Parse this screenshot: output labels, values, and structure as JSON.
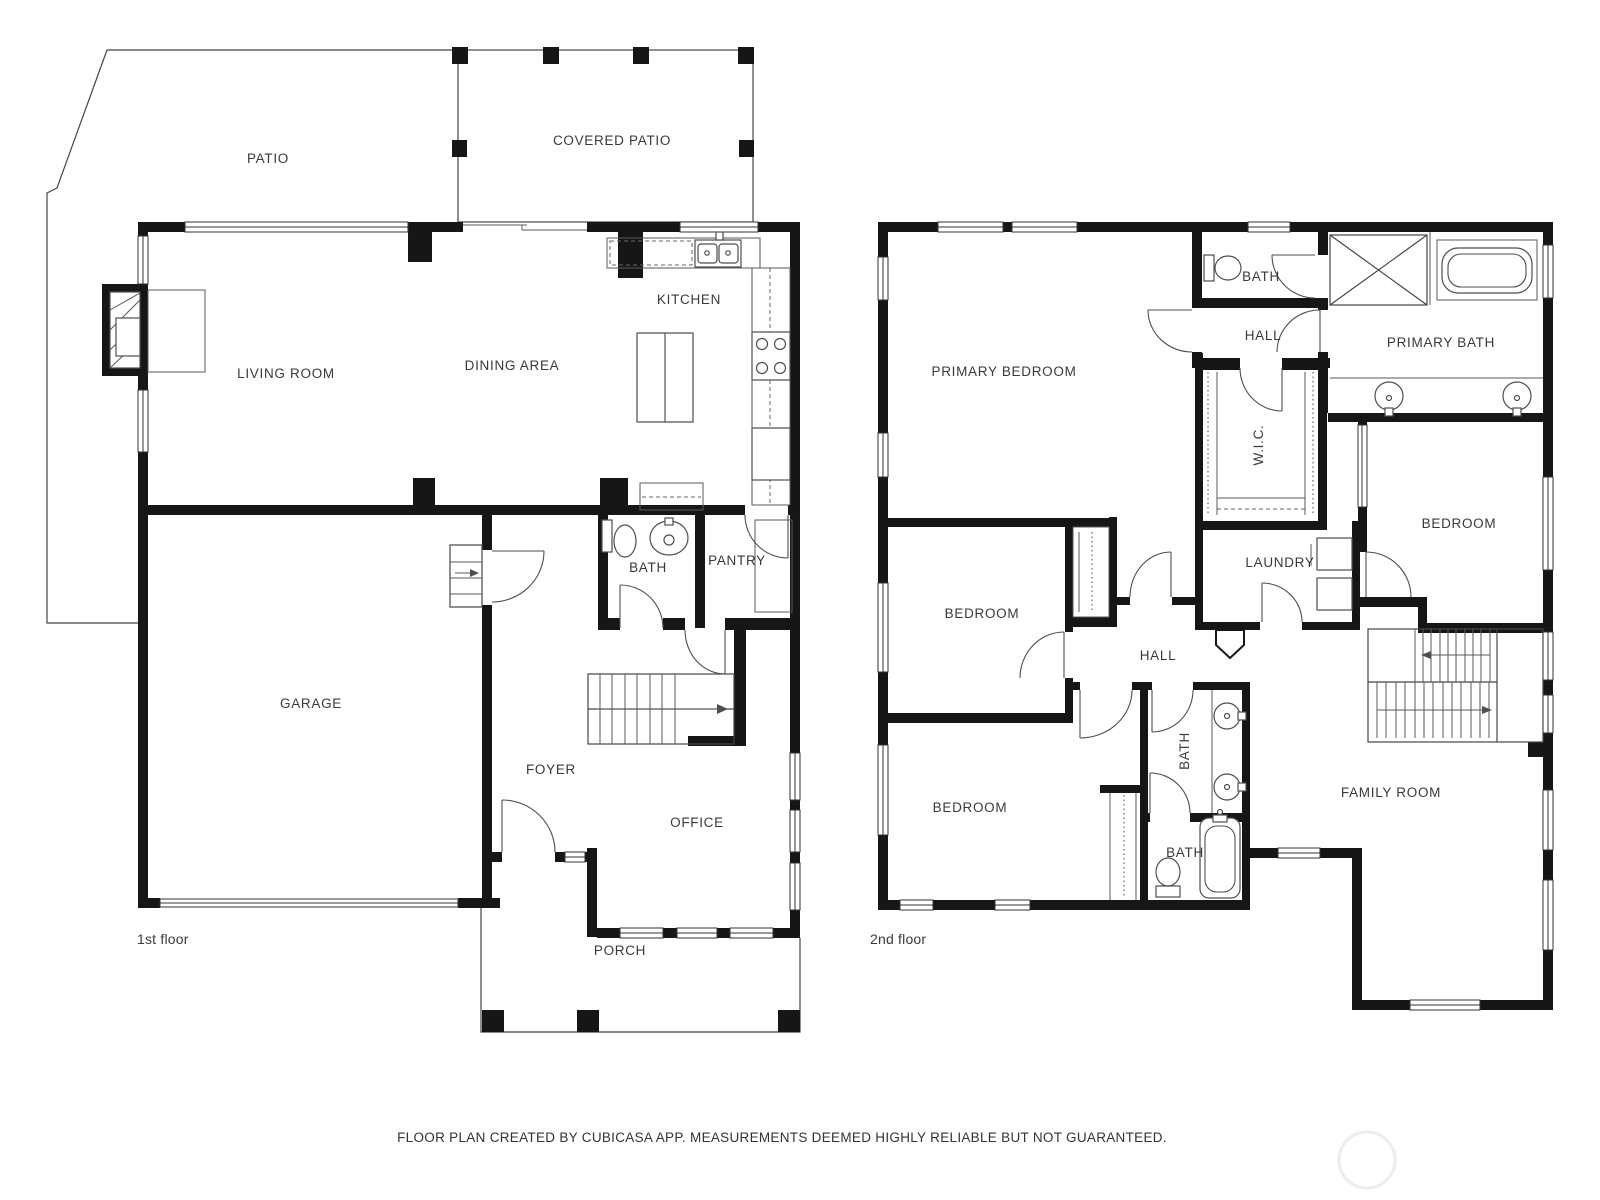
{
  "footer": "FLOOR PLAN CREATED BY CUBICASA APP. MEASUREMENTS DEEMED HIGHLY RELIABLE BUT NOT GUARANTEED.",
  "floor1": {
    "name": "1st floor",
    "rooms": {
      "patio": "PATIO",
      "covered_patio": "COVERED PATIO",
      "kitchen": "KITCHEN",
      "living_room": "LIVING ROOM",
      "dining_area": "DINING AREA",
      "bath": "BATH",
      "pantry": "PANTRY",
      "garage": "GARAGE",
      "foyer": "FOYER",
      "office": "OFFICE",
      "porch": "PORCH"
    }
  },
  "floor2": {
    "name": "2nd floor",
    "rooms": {
      "primary_bedroom": "PRIMARY BEDROOM",
      "bath_upper": "BATH",
      "hall_upper": "HALL",
      "primary_bath": "PRIMARY BATH",
      "wic": "W.I.C.",
      "bedroom_right": "BEDROOM",
      "laundry": "LAUNDRY",
      "bedroom_mid": "BEDROOM",
      "hall_mid": "HALL",
      "bath_mid": "BATH",
      "bedroom_lower": "BEDROOM",
      "bath_lower": "BATH",
      "family_room": "FAMILY ROOM"
    }
  },
  "colors": {
    "wall": "#161616",
    "text": "#3a3a3a",
    "background": "#ffffff"
  }
}
